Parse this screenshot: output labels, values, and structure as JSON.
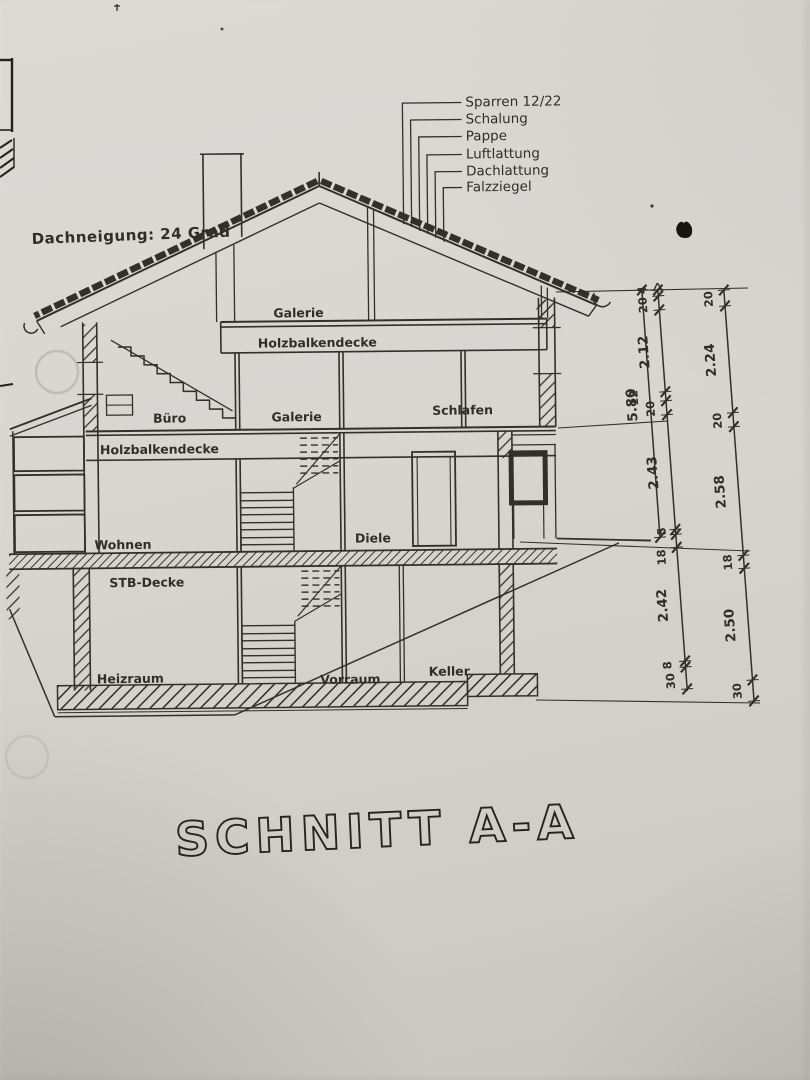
{
  "drawing": {
    "title": "SCHNITT A-A",
    "roof_pitch_note": "Dachneigung: 24 Grad",
    "roof_layer_callouts": [
      "Sparren 12/22",
      "Schalung",
      "Pappe",
      "Luftlattung",
      "Dachlattung",
      "Falzziegel"
    ],
    "labels": {
      "attic_gallery": "Galerie",
      "attic_ceiling": "Holzbalkendecke",
      "office": "Büro",
      "upper_gallery": "Galerie",
      "bedroom": "Schlafen",
      "upper_floor_deck": "Holzbalkendecke",
      "living_room": "Wohnen",
      "hallway": "Diele",
      "concrete_slab": "STB-Decke",
      "boiler_room": "Heizraum",
      "basement_hall": "Vorraum",
      "cellar": "Keller"
    },
    "dimensions": {
      "overall_height": "5.80",
      "inner_chain": [
        "4",
        "20",
        "2.12",
        "12",
        "20",
        "2.43",
        "5",
        "18",
        "2.42",
        "8",
        "30"
      ],
      "outer_chain": [
        "20",
        "2.24",
        "20",
        "2.58",
        "18",
        "2.50",
        "30"
      ]
    },
    "colors": {
      "paper": "#d7d5d0",
      "ink": "#25231f"
    }
  }
}
